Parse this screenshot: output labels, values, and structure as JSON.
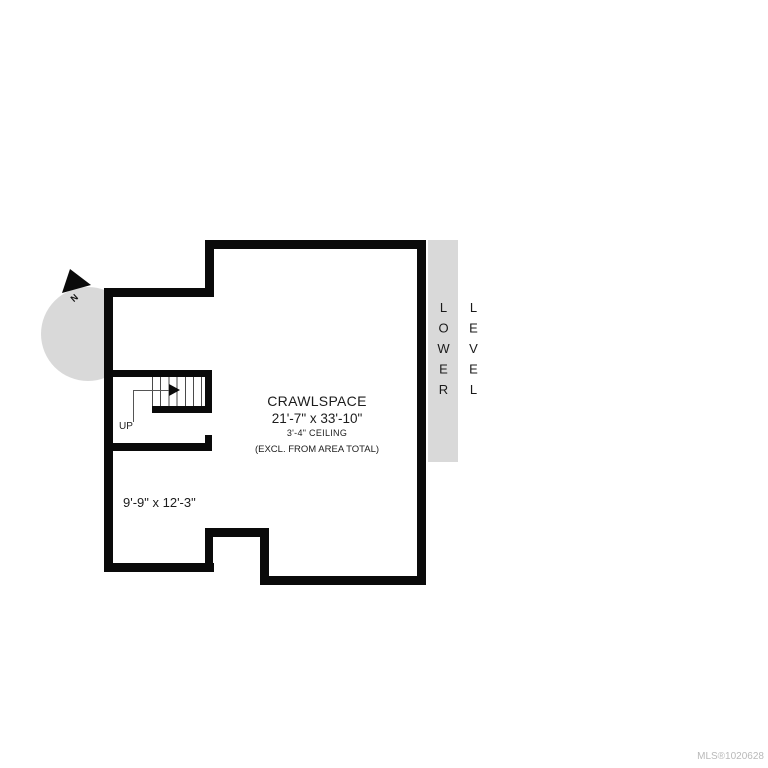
{
  "banner": {
    "text": "LOWER LEVEL",
    "background": "#d9d9d9"
  },
  "compass": {
    "label": "N",
    "circle_color": "#d9d9d9"
  },
  "stairs": {
    "direction_label": "UP"
  },
  "rooms": {
    "crawlspace": {
      "name": "CRAWLSPACE",
      "dimensions": "21'-7\" x 33'-10\"",
      "ceiling": "3'-4\" CEILING",
      "note": "(EXCL. FROM AREA TOTAL)"
    },
    "lower_left_room": {
      "dimensions": "9'-9\" x 12'-3\""
    }
  },
  "watermark": {
    "text": "MLS®1020628",
    "color": "#b9b9b9"
  },
  "colors": {
    "wall": "#0a0a0a",
    "background": "#ffffff",
    "accent_gray": "#d9d9d9"
  }
}
